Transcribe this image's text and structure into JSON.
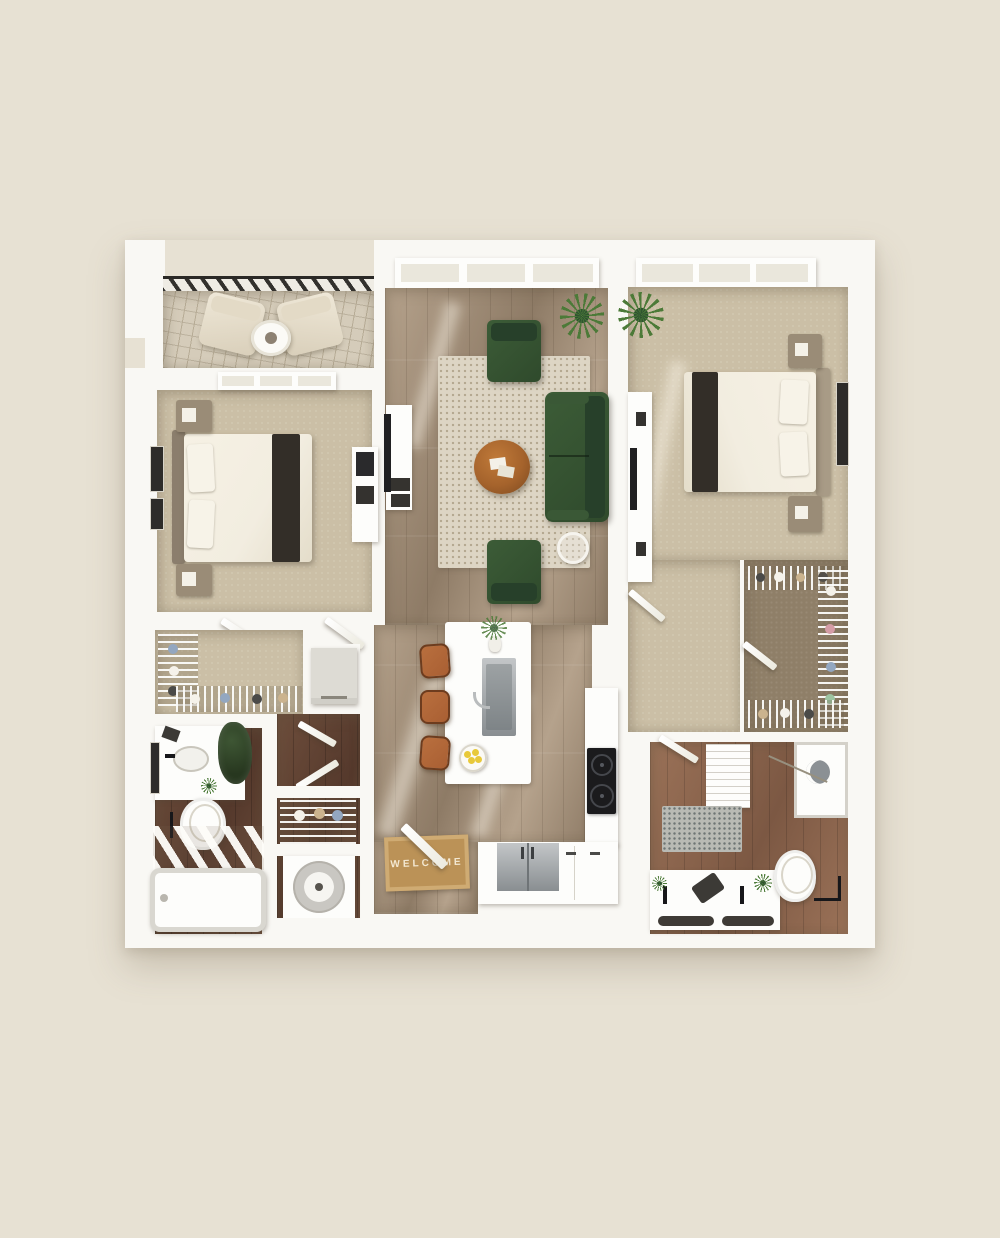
{
  "scene": {
    "kind": "3d-rendered-apartment-floor-plan-top-view",
    "entry": {
      "mat_text": "WELCOME"
    }
  },
  "rooms": [
    "balcony",
    "bedroom-1",
    "walk-in-closet-1",
    "bathroom-1",
    "laundry",
    "living-room",
    "dining-area",
    "kitchen",
    "entry",
    "bedroom-2",
    "dressing-area",
    "walk-in-closet-2",
    "bathroom-2"
  ],
  "furniture": [
    "patio-lounge-chairs",
    "patio-side-table",
    "queen-bed",
    "nightstands",
    "wall-art",
    "dresser-tv-console",
    "green-sofa",
    "green-accent-armchairs",
    "round-wood-coffee-table",
    "wire-side-table",
    "speckled-area-rug",
    "potted-plants",
    "kitchen-island-with-sink",
    "bar-stools",
    "cooktop",
    "refrigerator",
    "kitchen-cabinets",
    "welcome-mat",
    "stacked-washer-dryer",
    "wire-closet-shelving",
    "bathtub",
    "walk-in-shower",
    "toilets",
    "single-vanity",
    "double-vanity",
    "linen-shelves",
    "bath-rugs",
    "bowl-of-lemons"
  ],
  "colors": {
    "bg": "#e7e1d3",
    "wall": "#f9f8f4",
    "wallShade": "#eae7dc",
    "carpet": "#cbbfa6",
    "taupe": "#8f7f68",
    "woodA": "#b5a28c",
    "woodB": "#8e7b66",
    "bathDarkA": "#6e4e3c",
    "bathDarkB": "#55392c",
    "bathMidA": "#9b7258",
    "bathMidB": "#7c5843",
    "rug": "#ddd5c4",
    "rugDot": "#b3a78f",
    "balcony": "#d5ccba",
    "balconyLine": "#b7ac96",
    "railing": "#33312d",
    "green": "#2f4a2c",
    "greenLight": "#3c5c37",
    "linen": "#f2ede0",
    "runner": "#332e28",
    "headboard1": "#8b7e6d",
    "headboard2": "#a89b86",
    "nightstand": "#9a8c77",
    "tableWood": "#a5632c",
    "tableWoodDark": "#7c491f",
    "stool": "#a95f33",
    "steel": "#c3c6c8",
    "steelDark": "#898e91",
    "black": "#1b1b1d",
    "matBase": "#bb9257",
    "matBorder": "#cfab73",
    "matText": "#f3e8d2",
    "frame": "#2e2c29",
    "plant": "#4c7a38",
    "plantDark": "#2f5430",
    "grayRug": "#b9bab4",
    "grayRugDot": "#6f7574",
    "fixture": "#fdfdfb",
    "appliance": "#dddbd4",
    "lemon": "#e8c93a",
    "clothes1": "#d49ca6",
    "clothes2": "#93a7c0",
    "clothes3": "#9dc4a1",
    "clothes4": "#cbb38e",
    "clothes5": "#f5f2ea",
    "clothes6": "#4a4a48"
  }
}
